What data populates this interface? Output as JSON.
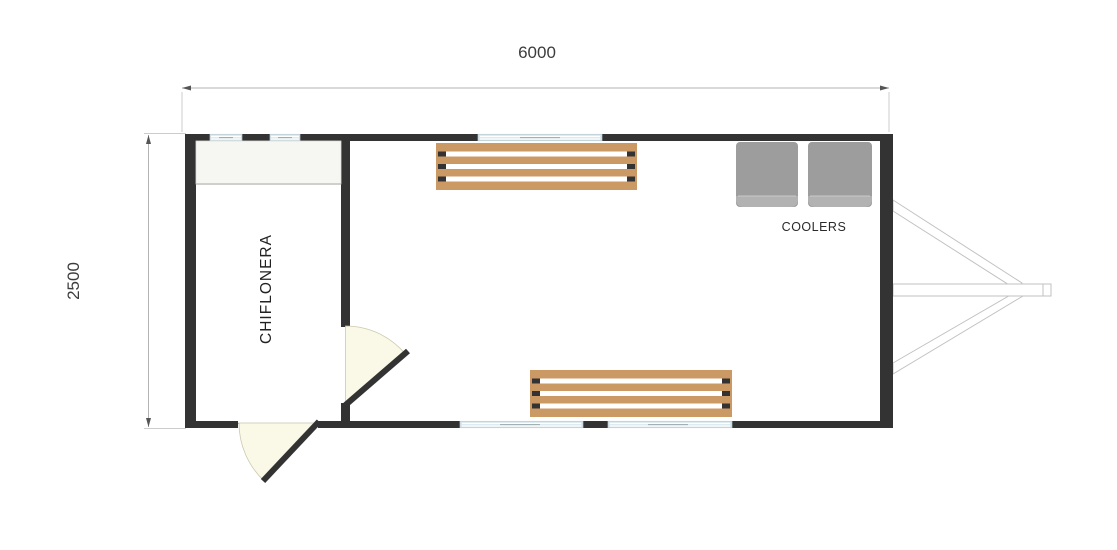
{
  "annotations": {
    "width_dim": "6000",
    "height_dim": "2500"
  },
  "room": {
    "name": "CHIFLONERA"
  },
  "equipment": {
    "coolers_label": "COOLERS",
    "cooler_count": 2,
    "bench_count": 2
  },
  "colors": {
    "background": "#ffffff",
    "wall": "#333333",
    "window_glass": "#d9e8ee",
    "window_frame": "#b7c9cf",
    "shelf": "#f6f6f3",
    "shelf_edge": "#cfcfcd",
    "bench_wood": "#cb9a64",
    "bench_cap": "#333333",
    "cooler_body": "#9d9d9d",
    "cooler_lid": "#b2b2b2",
    "door_swing": "#faf8e6",
    "door_swing_edge": "#ccc9ae",
    "door_leaf": "#333333",
    "hitch_outline": "#c2c2c2",
    "dim_line": "#b3b3b3",
    "ext_line": "#cccccc",
    "arrow": "#555555",
    "label_text": "#3c3c3c"
  }
}
